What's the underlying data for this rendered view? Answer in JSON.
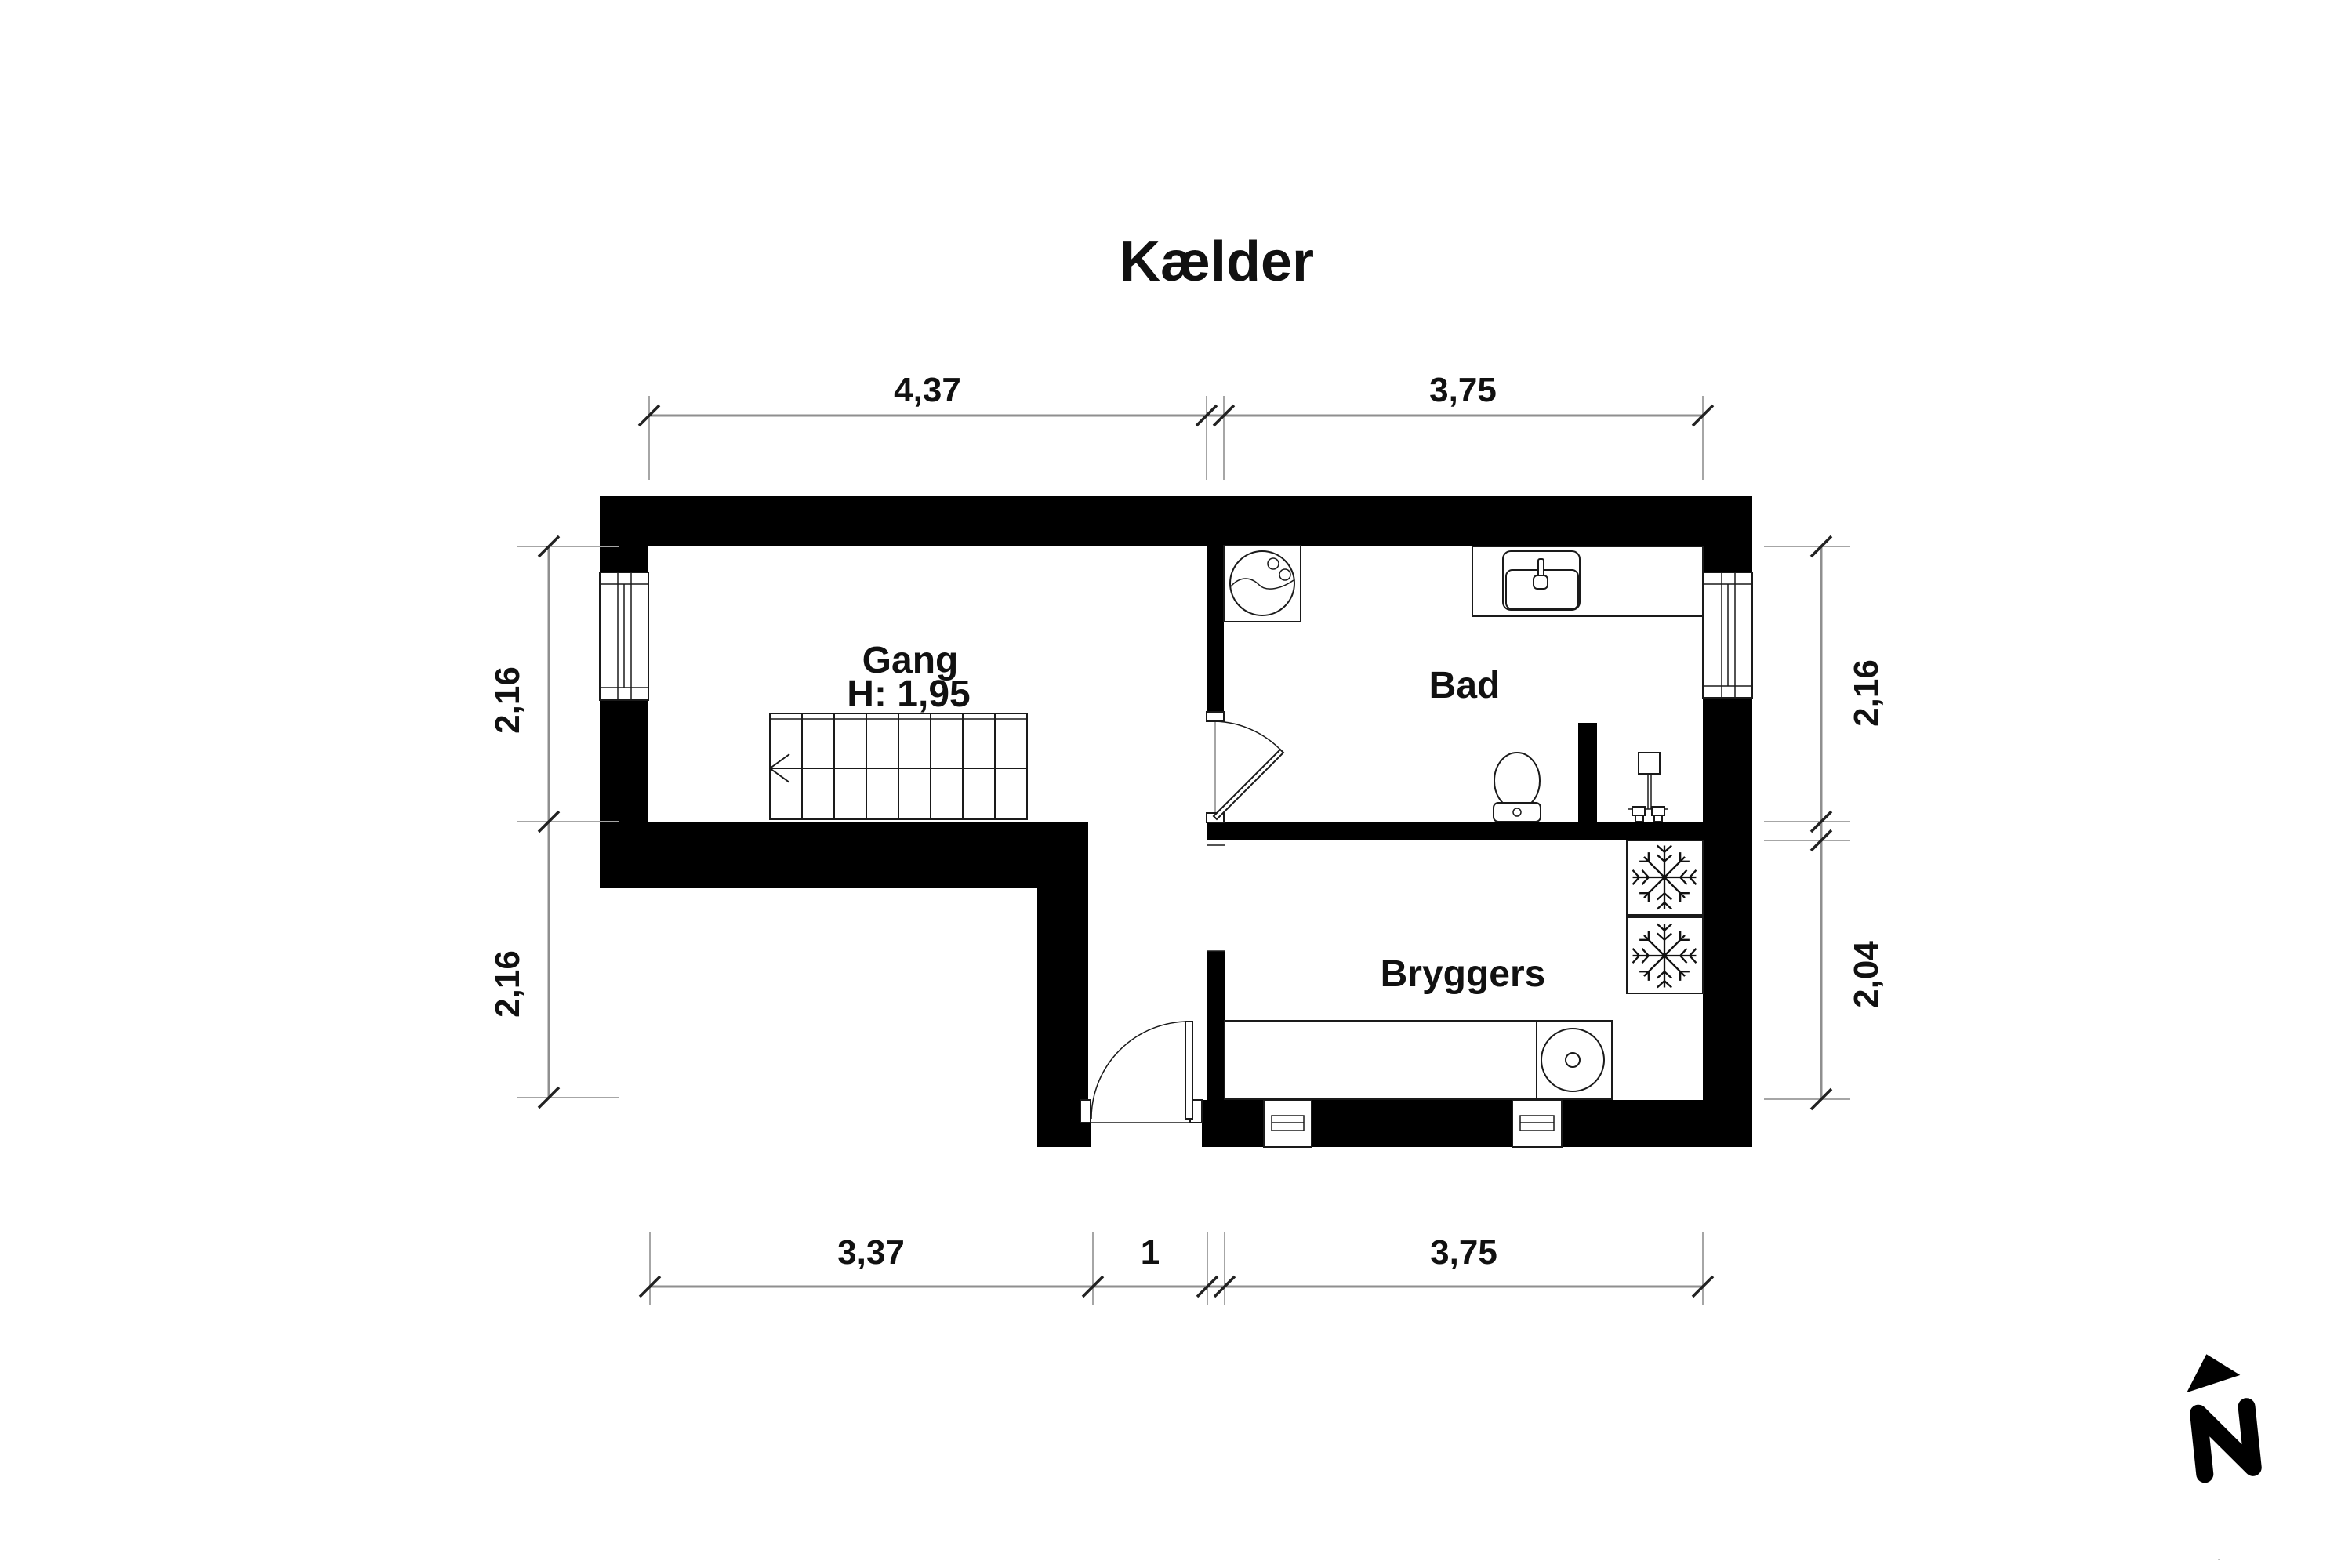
{
  "title": "Kælder",
  "rooms": {
    "gang": {
      "name": "Gang",
      "ceiling_height": "H: 1,95"
    },
    "bad": {
      "name": "Bad"
    },
    "bryggers": {
      "name": "Bryggers"
    }
  },
  "dimensions": {
    "top": [
      "4,37",
      "3,75"
    ],
    "bottom": [
      "3,37",
      "1",
      "3,75"
    ],
    "left": [
      "2,16",
      "2,16"
    ],
    "right": [
      "2,16",
      "2,04"
    ]
  },
  "compass": {
    "north_label": "N"
  },
  "icons": [
    "stairs",
    "stair-direction-arrow",
    "window",
    "door-swing",
    "washing-machine-icon",
    "sink-icon",
    "toilet-icon",
    "shower-mixer-icon",
    "utility-sink-icon",
    "snowflake-icon",
    "vent-window",
    "north-arrow-icon"
  ],
  "colors": {
    "wall": "#000000",
    "dim_line": "#8f8f8f",
    "text": "#111111",
    "background": "#ffffff"
  }
}
